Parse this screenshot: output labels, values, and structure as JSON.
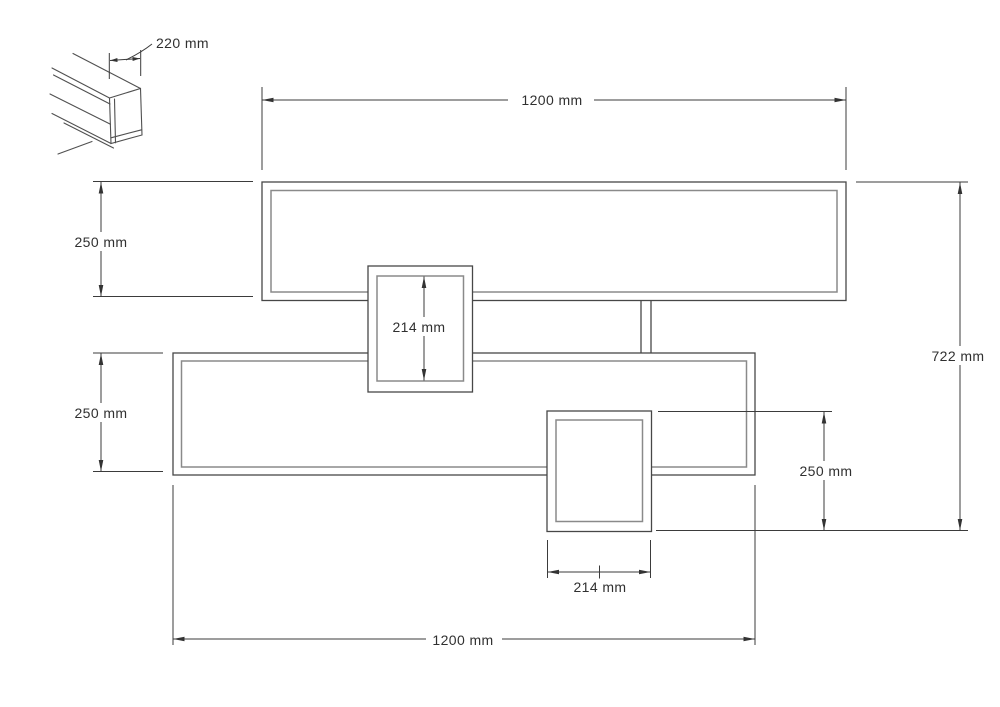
{
  "drawing": {
    "type": "technical-drawing",
    "unit": "mm",
    "labels": {
      "profile_depth": "220 mm",
      "top_width": "1200 mm",
      "upper_shelf_height": "250 mm",
      "middle_box_height": "214 mm",
      "overall_height": "722 mm",
      "lower_shelf_height": "250 mm",
      "lower_box_height": "250 mm",
      "lower_box_width": "214 mm",
      "bottom_width": "1200 mm"
    },
    "values": {
      "profile_depth": 220,
      "top_width": 1200,
      "upper_shelf_height": 250,
      "middle_box_height": 214,
      "overall_height": 722,
      "lower_shelf_height": 250,
      "lower_box_height": 250,
      "lower_box_width": 214,
      "bottom_width": 1200
    },
    "colors": {
      "background": "#ffffff",
      "outline": "#474747",
      "inner_line": "#8a8a8a",
      "dimension_line": "#3b3b3b",
      "text": "#303030"
    }
  }
}
